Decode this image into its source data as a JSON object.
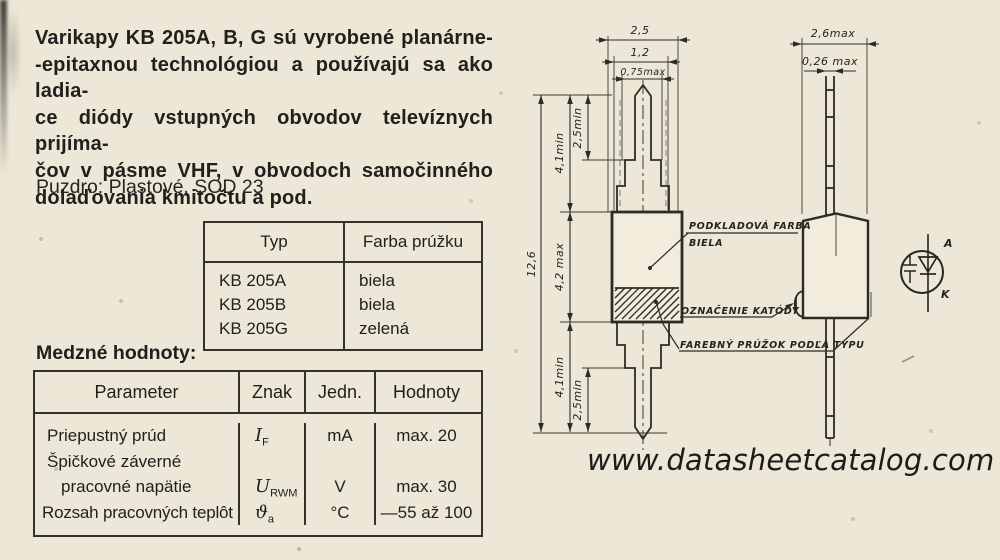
{
  "page": {
    "background": "#ece7d6",
    "ink": "#2e2b25"
  },
  "intro": {
    "lines": [
      "Varikapy KB 205A, B, G sú vyrobené planárne-",
      "-epitaxnou technológiou a používajú sa ako ladia-",
      "ce diódy vstupných obvodov televíznych prijíma-",
      "čov v pásme VHF, v obvodoch samočinného",
      "dolaďovania kmitočtu a pod."
    ]
  },
  "package_line": "Puzdro: Plastové, SOD 23",
  "type_table": {
    "headers": [
      "Typ",
      "Farba prúžku"
    ],
    "rows": [
      [
        "KB 205A",
        "biela"
      ],
      [
        "KB 205B",
        "biela"
      ],
      [
        "KB 205G",
        "zelená"
      ]
    ]
  },
  "limits": {
    "title": "Medzné hodnoty:",
    "headers": [
      "Parameter",
      "Znak",
      "Jedn.",
      "Hodnoty"
    ],
    "lines": [
      {
        "p": "Priepustný prúd",
        "s": "I",
        "ss": "F",
        "u": "mA",
        "v": "max. 20"
      },
      {
        "p": "Špičkové záverné",
        "s": "",
        "ss": "",
        "u": "",
        "v": ""
      },
      {
        "p": "pracovné napätie",
        "s": "U",
        "ss": "RWM",
        "u": "V",
        "v": "max. 30"
      },
      {
        "p": "Rozsah pracovných teplôt",
        "s": "ϑ",
        "ss": "a",
        "u": "°C",
        "v": "—55 až 100"
      }
    ]
  },
  "drawing": {
    "dims": {
      "front_width": "2,5",
      "front_width_mid": "1,2",
      "front_width_tip": "0,75max",
      "overall_length": "12,6",
      "lead_top": "4,1min",
      "tip_top": "2,5min",
      "body_length": "4,2 max",
      "lead_bottom": "4,1min",
      "tip_bottom": "2,5min",
      "side_width": "2,6max",
      "side_lead_thickness": "0,26 max"
    },
    "labels": {
      "base_color_1": "PODKLADOVÁ FARBA",
      "base_color_2": "BIELA",
      "cathode_mark": "OZNAČENIE KATÓDY",
      "stripe": "FAREBNÝ PRÚŽOK PODĽA TYPU"
    },
    "symbol": {
      "anode": "A",
      "cathode": "K"
    }
  },
  "watermark": "www.datasheetcatalog.com"
}
